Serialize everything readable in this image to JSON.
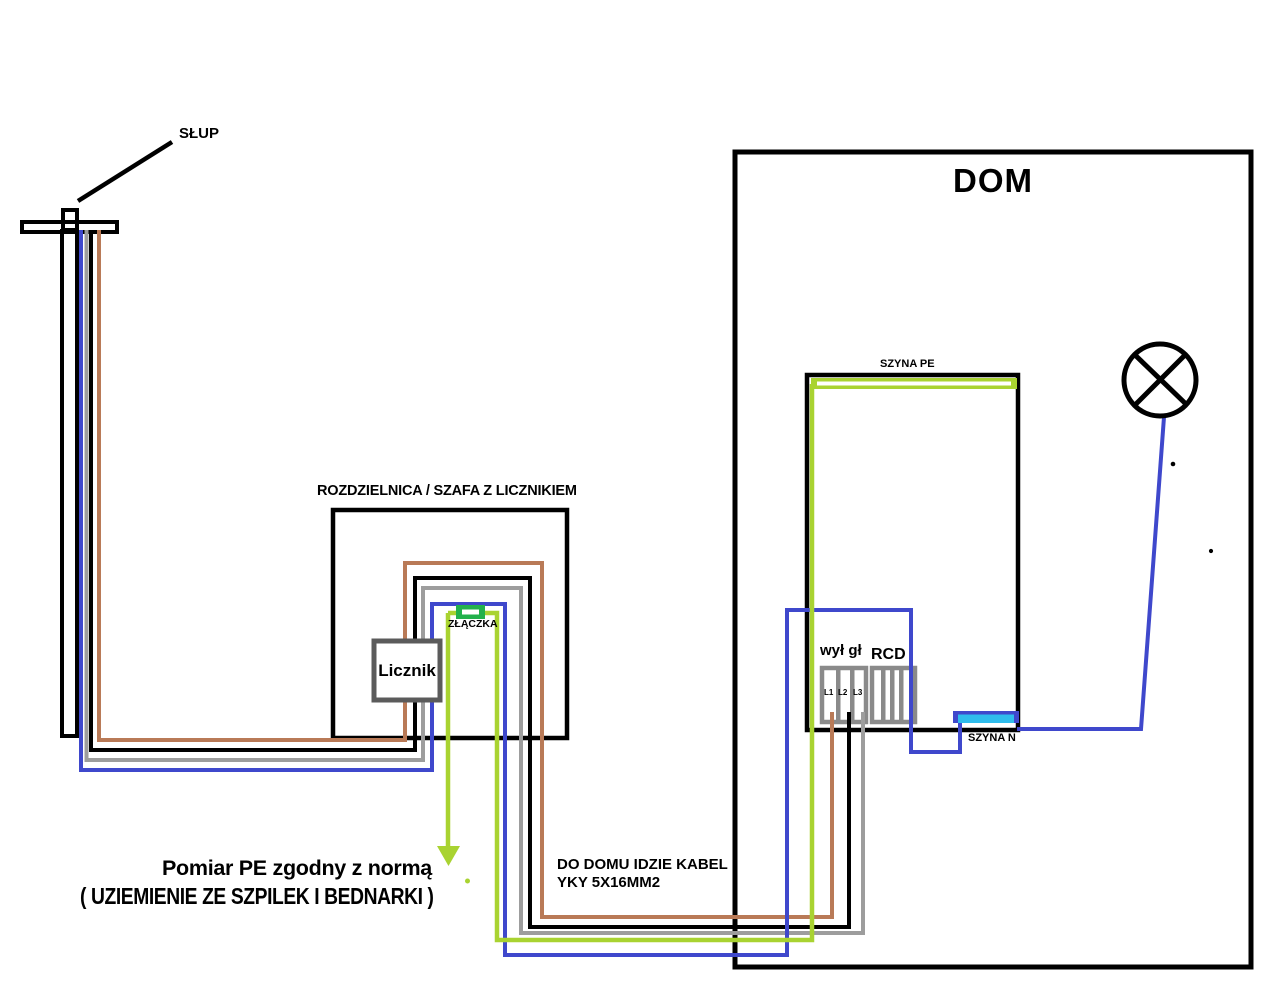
{
  "colors": {
    "black": "#000000",
    "blue": "#3f48cc",
    "gray": "#9d9d9d",
    "brown": "#b97a57",
    "green_yellow": "#a9d331",
    "green": "#22b14c",
    "cyan": "#2fbcec",
    "meter_gray": "#5b5b5b",
    "switch_gray": "#8a8a8a"
  },
  "labels": {
    "pole": "SŁUP",
    "house": "DOM",
    "cabinet": "ROZDZIELNICA / SZAFA Z LICZNIKIEM",
    "connector": "ZŁĄCZKA",
    "meter": "Licznik",
    "pe_bus": "SZYNA PE",
    "n_bus": "SZYNA N",
    "main_switch": "wył gł",
    "rcd": "RCD",
    "l1": "L1",
    "l2": "L2",
    "l3": "L3",
    "pe_note_title": "Pomiar PE zgodny z normą",
    "pe_note_sub": "( UZIEMIENIE ZE SZPILEK I BEDNARKI )",
    "cable_note_line1": "DO DOMU IDZIE KABEL",
    "cable_note_line2": "YKY 5X16MM2"
  }
}
